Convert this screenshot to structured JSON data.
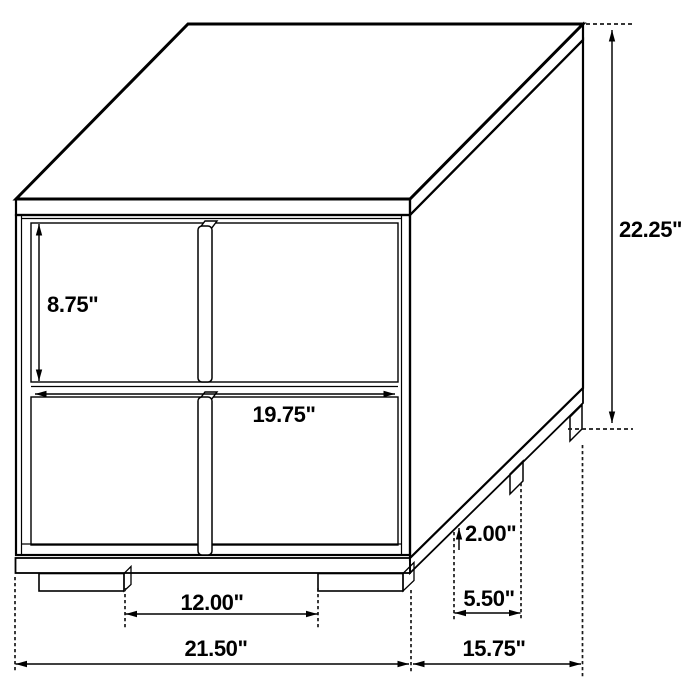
{
  "diagram": {
    "kind": "furniture-dimension-drawing",
    "units": "inches"
  },
  "dimensions": {
    "overall_height": {
      "label": "22.25\"",
      "value": 22.25
    },
    "drawer_height": {
      "label": "8.75\"",
      "value": 8.75
    },
    "front_inner_width": {
      "label": "19.75\"",
      "value": 19.75
    },
    "leg_height": {
      "label": "2.00\"",
      "value": 2.0
    },
    "side_leg_spacing": {
      "label": "5.50\"",
      "value": 5.5
    },
    "front_leg_spacing": {
      "label": "12.00\"",
      "value": 12.0
    },
    "overall_width": {
      "label": "21.50\"",
      "value": 21.5
    },
    "overall_depth": {
      "label": "15.75\"",
      "value": 15.75
    }
  },
  "colors": {
    "line": "#000000",
    "background": "#ffffff"
  }
}
